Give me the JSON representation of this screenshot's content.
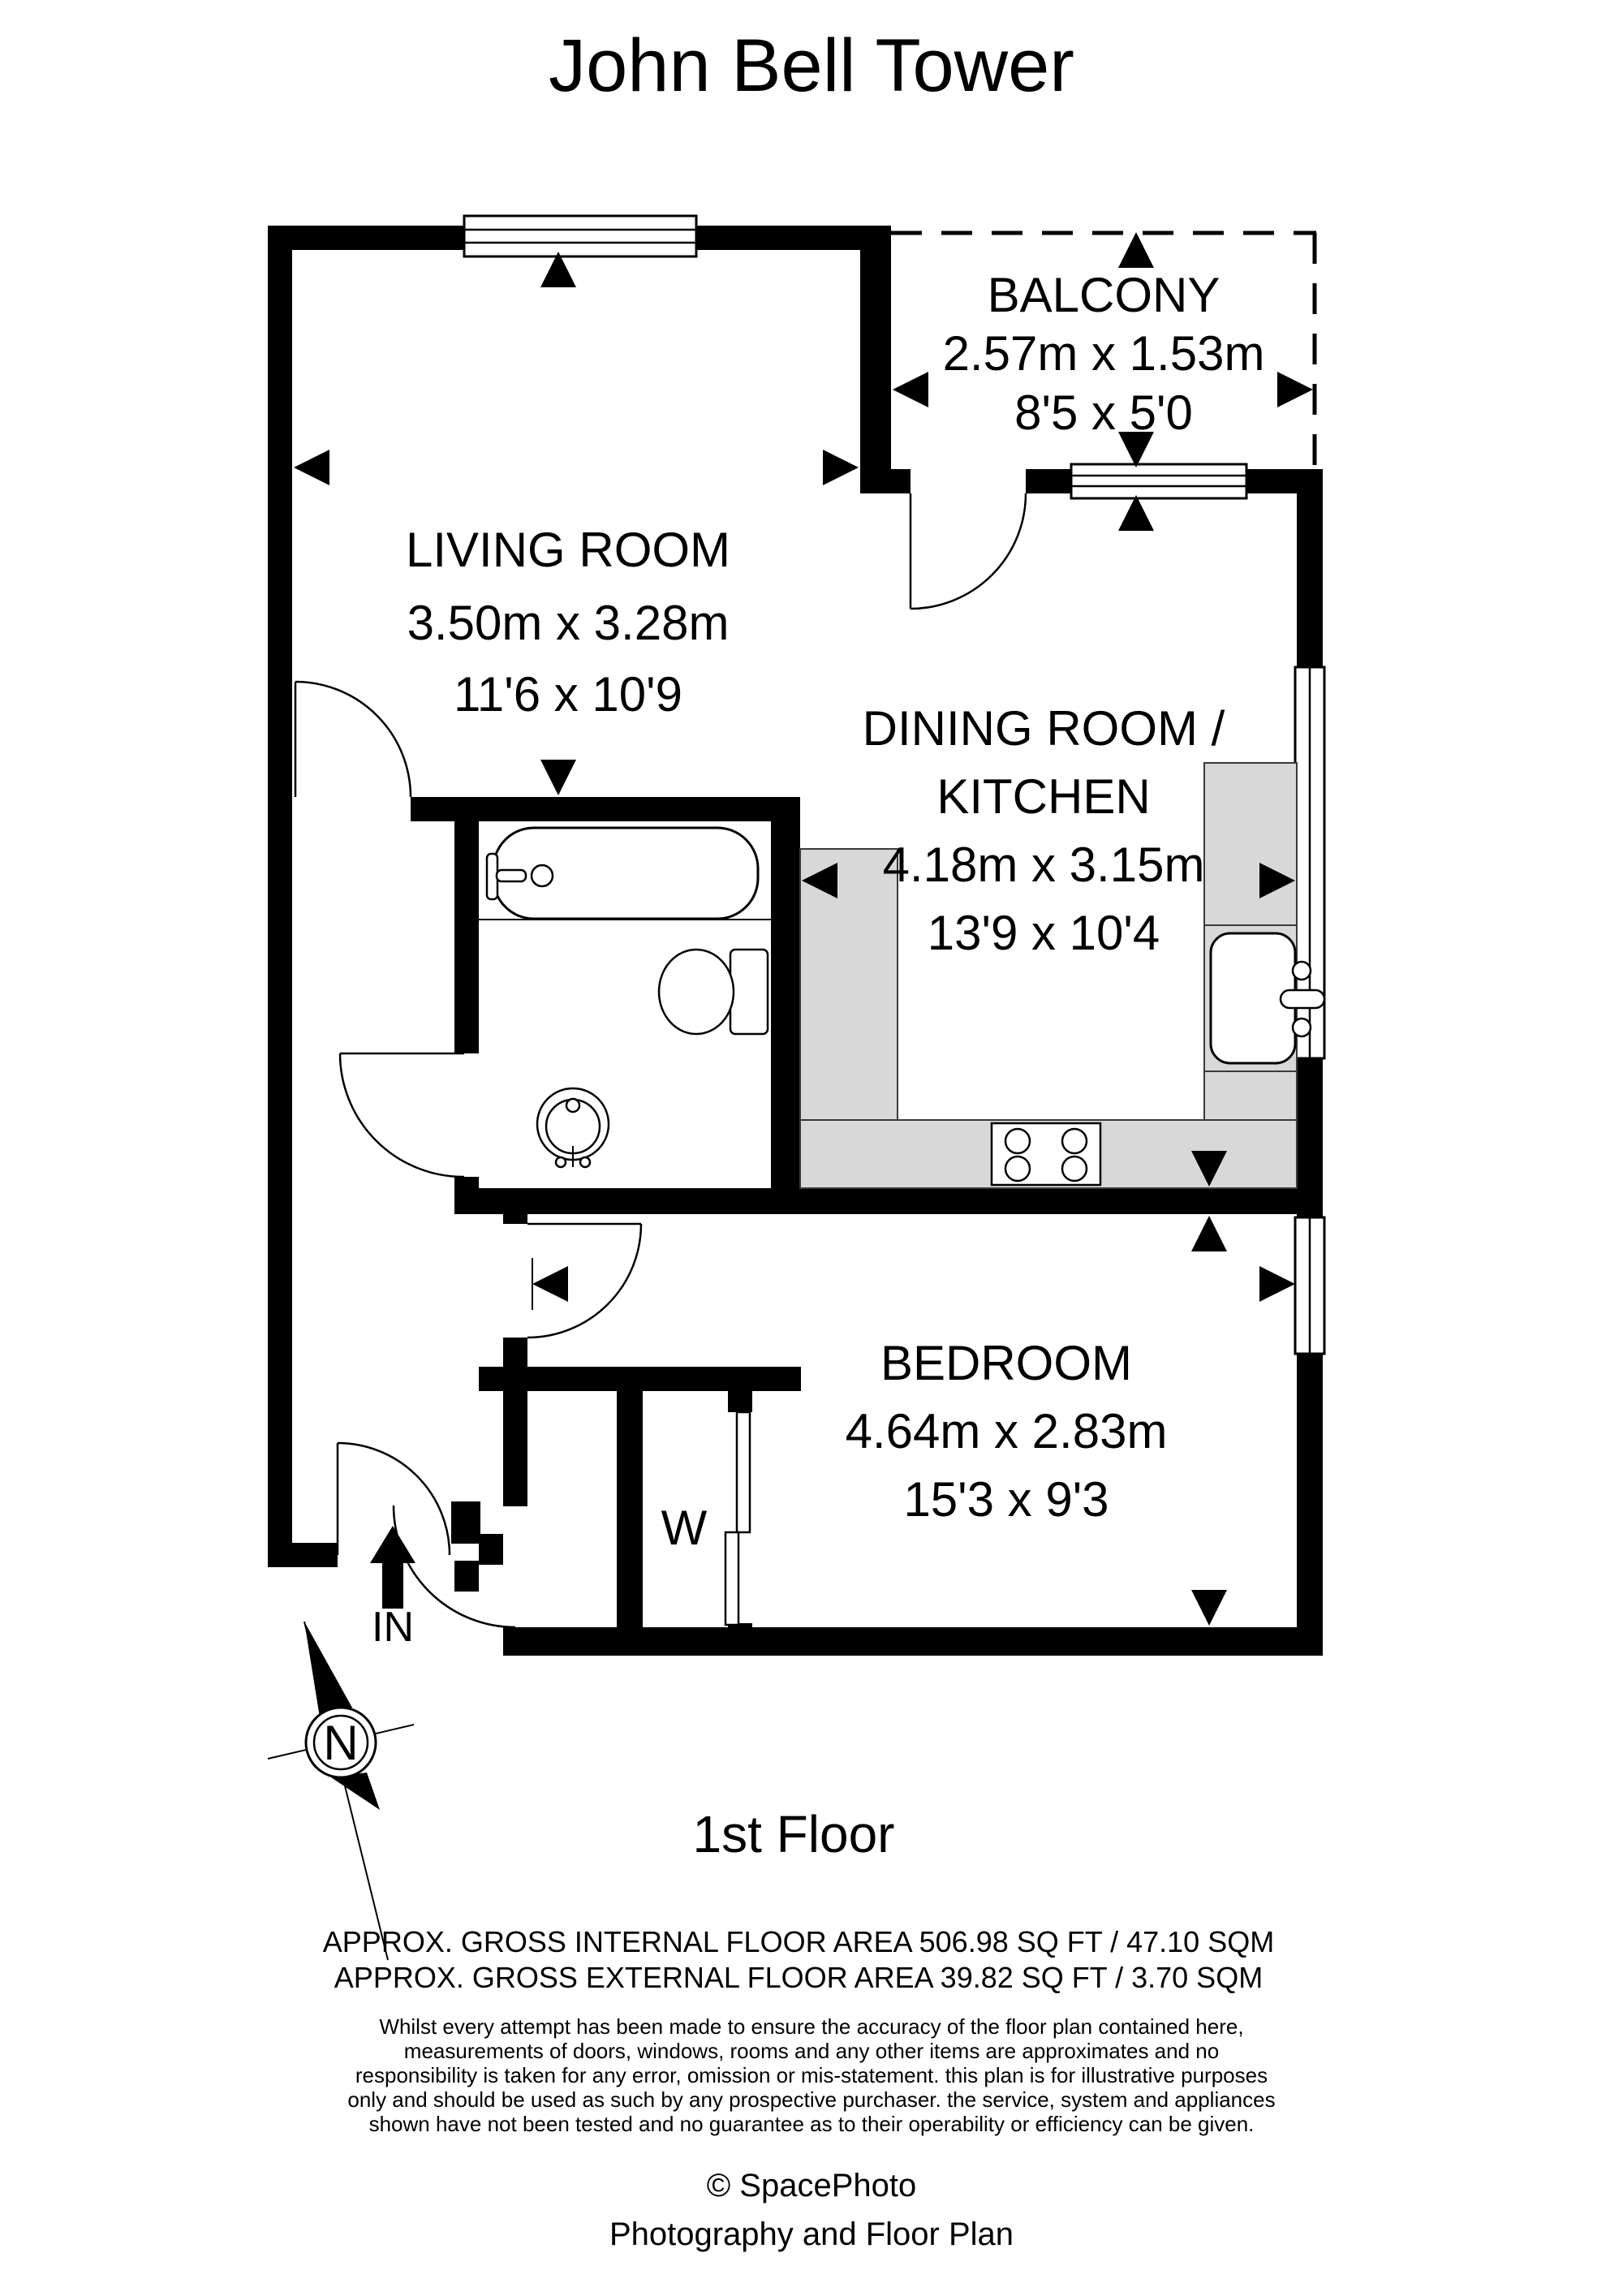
{
  "title": "John Bell Tower",
  "floor": "1st Floor",
  "rooms": {
    "living": {
      "name": "LIVING ROOM",
      "metric": "3.50m x 3.28m",
      "imperial": "11'6 x 10'9"
    },
    "balcony": {
      "name": "BALCONY",
      "metric": "2.57m x 1.53m",
      "imperial": "8'5 x 5'0"
    },
    "dining": {
      "name1": "DINING ROOM /",
      "name2": "KITCHEN",
      "metric": "4.18m x 3.15m",
      "imperial": "13'9 x 10'4"
    },
    "bedroom": {
      "name": "BEDROOM",
      "metric": "4.64m x 2.83m",
      "imperial": "15'3 x 9'3"
    }
  },
  "markers": {
    "wardrobe": "W",
    "entrance": "IN",
    "north": "N"
  },
  "areas": {
    "internal": "APPROX. GROSS INTERNAL FLOOR AREA 506.98 SQ FT / 47.10 SQM",
    "external": "APPROX. GROSS EXTERNAL FLOOR AREA 39.82 SQ FT / 3.70 SQM"
  },
  "disclaimer": [
    "Whilst every attempt has been made to ensure the accuracy of the floor plan contained here,",
    "measurements of doors, windows, rooms and any other items are approximates and no",
    "responsibility is taken for any error, omission or mis-statement. this plan is for illustrative purposes",
    "only and should be used as such by any prospective purchaser. the service, system and appliances",
    "shown have not been tested and no guarantee as to their operability or efficiency can be given."
  ],
  "credit": {
    "copyright": "© SpacePhoto",
    "tagline": "Photography and Floor Plan"
  },
  "colors": {
    "wall": "#000000",
    "counter": "#d8d8d8",
    "background": "#ffffff",
    "text": "#000000"
  }
}
